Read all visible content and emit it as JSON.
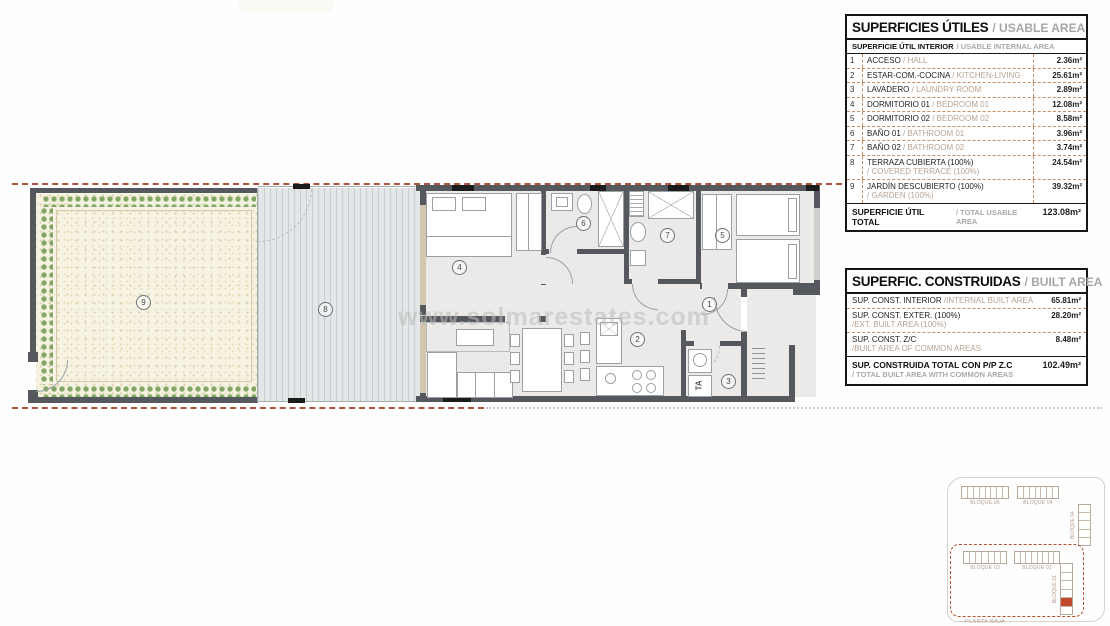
{
  "watermark": "www.solmarestates.com",
  "usable_table": {
    "title_es": "SUPERFICIES ÚTILES",
    "title_en": "/ USABLE AREA",
    "sub_es": "SUPERFICIE ÚTIL INTERIOR",
    "sub_en": "/ USABLE INTERNAL AREA",
    "rows": [
      {
        "num": "1",
        "es": "ACCESO",
        "en": "/ HALL",
        "value": "2.36m²"
      },
      {
        "num": "2",
        "es": "ESTAR-COM.-COCINA",
        "en": "/ KITCHEN-LIVING",
        "value": "25.61m²"
      },
      {
        "num": "3",
        "es": "LAVADERO",
        "en": "/ LAUNDRY ROOM",
        "value": "2.89m²"
      },
      {
        "num": "4",
        "es": "DORMITORIO 01",
        "en": "/ BEDROOM 01",
        "value": "12.08m²"
      },
      {
        "num": "5",
        "es": "DORMITORIO 02",
        "en": "/ BEDROOM 02",
        "value": "8.58m²"
      },
      {
        "num": "6",
        "es": "BAÑO 01",
        "en": "/ BATHROOM 01",
        "value": "3.96m²"
      },
      {
        "num": "7",
        "es": "BAÑO 02",
        "en": "/ BATHROOM 02",
        "value": "3.74m²"
      },
      {
        "num": "8",
        "es": "TERRAZA CUBIERTA (100%)",
        "en": "/ COVERED TERRACE (100%)",
        "value": "24.54m²"
      },
      {
        "num": "9",
        "es": "JARDÍN DESCUBIERTO (100%)",
        "en": "/ GARDEN (100%)",
        "value": "39.32m²"
      }
    ],
    "total_es": "SUPERFICIE ÚTIL TOTAL",
    "total_en": "/ TOTAL USABLE AREA",
    "total_value": "123.08m²"
  },
  "built_table": {
    "title_es": "SUPERFIC. CONSTRUIDAS",
    "title_en": "/ BUILT AREA",
    "rows": [
      {
        "es": "SUP. CONST. INTERIOR",
        "en": "/INTERNAL BUILT AREA",
        "value": "65.81m²"
      },
      {
        "es": "SUP. CONST. EXTER. (100%)",
        "en": "/EXT. BUILT AREA (100%)",
        "value": "28.20m²"
      },
      {
        "es": "SUP. CONST. Z/C",
        "en": "/BUILT AREA OF COMMON AREAS",
        "value": "8.48m²"
      }
    ],
    "total_es": "SUP. CONSTRUIDA TOTAL CON P/P Z.C",
    "total_en": "/ TOTAL BUILT AREA WITH COMMON AREAS",
    "total_value": "102.49m²"
  },
  "plan": {
    "rooms": [
      "1",
      "2",
      "3",
      "4",
      "5",
      "6",
      "7",
      "8",
      "9"
    ],
    "laundry_label": "TA"
  },
  "keyplan": {
    "block_top_left": "BLOQUE 05",
    "block_top_right": "BLOQUE 04",
    "block_right": "BLOQUE 04",
    "block_bottom_left": "BLOQUE 03",
    "block_bottom_mid": "BLOQUE 02",
    "block_bottom_right": "BLOQUE 01",
    "caption": "PLANTA BAJA"
  },
  "colors": {
    "boundary_dash": "#a9543b",
    "table_dash": "#c98f63",
    "highlight_unit": "#c2492c",
    "wall": "#55595d"
  }
}
